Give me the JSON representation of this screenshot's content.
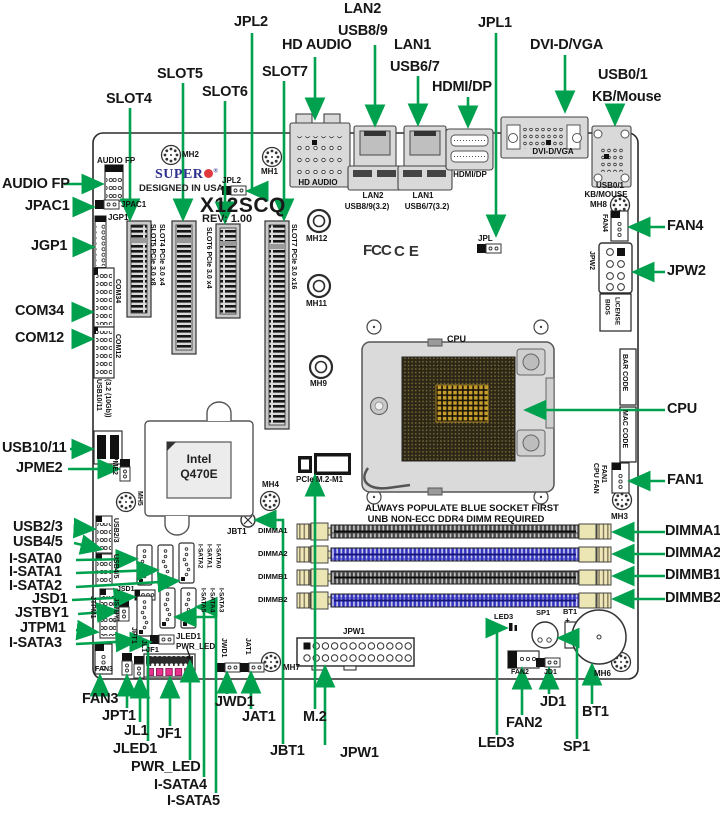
{
  "board": {
    "brand": "SUPER",
    "reg": "®",
    "designed": "DESIGNED IN USA",
    "model": "X12SCQ",
    "rev": "REV: 1.00",
    "fcc": "FCC",
    "ce": "CE",
    "cpu": "CPU",
    "chip_line1": "Intel",
    "chip_line2": "Q470E",
    "note_line1": "ALWAYS POPULATE BLUE SOCKET FIRST",
    "note_line2": "UNB NON-ECC DDR4 DIMM REQUIRED"
  },
  "colors": {
    "arrow_green": "#00A14E",
    "dimm_blue": "#3232C0",
    "logo_blue": "#2F2F8F",
    "logo_red": "#E03A3E",
    "front_panel_magenta": "#E8318A"
  },
  "callouts": {
    "top": {
      "lan2": "LAN2",
      "usb89": "USB8/9",
      "hd_audio": "HD AUDIO",
      "lan1": "LAN1",
      "usb67": "USB6/7",
      "jpl1": "JPL1",
      "dvi": "DVI-D/VGA",
      "hdmi_dp": "HDMI/DP",
      "usb01": "USB0/1",
      "kb_mouse": "KB/Mouse",
      "jpl2": "JPL2",
      "slot4": "SLOT4",
      "slot5": "SLOT5",
      "slot6": "SLOT6",
      "slot7": "SLOT7"
    },
    "left": {
      "audio_fp": "AUDIO FP",
      "jpac1": "JPAC1",
      "jgp1": "JGP1",
      "com34": "COM34",
      "com12": "COM12",
      "usb1011": "USB10/11",
      "jpme2": "JPME2",
      "usb23": "USB2/3",
      "usb45": "USB4/5",
      "isata0": "I-SATA0",
      "isata1": "I-SATA1",
      "isata2": "I-SATA2",
      "jsd1": "JSD1",
      "jstby1": "JSTBY1",
      "jtpm1": "JTPM1",
      "isata3": "I-SATA3"
    },
    "right": {
      "fan4": "FAN4",
      "jpw2": "JPW2",
      "cpu": "CPU",
      "fan1": "FAN1",
      "dimma1": "DIMMA1",
      "dimma2": "DIMMA2",
      "dimmb1": "DIMMB1",
      "dimmb2": "DIMMB2"
    },
    "bottom": {
      "fan3": "FAN3",
      "jpt1": "JPT1",
      "jl1": "JL1",
      "jf1": "JF1",
      "jled1": "JLED1",
      "pwr_led": "PWR_LED",
      "isata4": "I-SATA4",
      "isata5": "I-SATA5",
      "jwd1": "JWD1",
      "jat1": "JAT1",
      "jbt1": "JBT1",
      "m2": "M.2",
      "jpw1": "JPW1",
      "fan2": "FAN2",
      "led3": "LED3",
      "jd1": "JD1",
      "bt1": "BT1",
      "sp1": "SP1"
    }
  },
  "ports": {
    "hd_audio": "HD AUDIO",
    "lan2": "LAN2",
    "usb89": "USB8/9(3.2)",
    "lan1": "LAN1",
    "usb67": "USB6/7(3.2)",
    "hdmi_dp": "HDMI/DP",
    "dvi": "DVI-D/VGA",
    "usb01": "USB0/1",
    "kb_mouse": "KB/MOUSE"
  },
  "stickers": {
    "bios_line1": "BIOS",
    "bios_line2": "LICENSE",
    "bar_code": "BAR CODE",
    "mac_code": "MAC CODE"
  },
  "silkscreen": {
    "audio_fp": "AUDIO FP",
    "jpac1": "JPAC1",
    "jgp1": "JGP1",
    "com34": "COM34",
    "com12": "COM12",
    "usb1011_a": "USB10/11",
    "usb1011_b": "(3.2 (10Gb))",
    "jpme2": "JPME2",
    "jpl2": "JPL2",
    "jpl": "JPL",
    "mh1": "MH1",
    "mh2": "MH2",
    "mh3": "MH3",
    "mh4": "MH4",
    "mh5": "MH5",
    "mh6": "MH6",
    "mh7": "MH7",
    "mh8": "MH8",
    "mh9": "MH9",
    "mh11": "MH11",
    "mh12": "MH12",
    "fan4": "FAN4",
    "jpw2": "JPW2",
    "fan1": "FAN1",
    "cpu_fan": "CPU FAN",
    "slot4": "SLOT4 PCIe 3.0 x4",
    "slot5": "SLOT5 PCIe 3.0 x8",
    "slot6": "SLOT6 PCIe 3.0 x4",
    "slot7": "SLOT7 PCIe 3.0 x16",
    "m2": "PCIe M.2-M1",
    "jbt1": "JBT1",
    "dimma1": "DIMMA1",
    "dimma2": "DIMMA2",
    "dimmb1": "DIMMB1",
    "dimmb2": "DIMMB2",
    "usb23": "USB2/3",
    "usb45": "USB4/5",
    "sata_r1": [
      "I-SATA2",
      "I-SATA1",
      "I-SATA0"
    ],
    "sata_r2": [
      "I-SATA5",
      "I-SATA4",
      "I-SATA3"
    ],
    "jsd1": "JSD1",
    "jstby1": "JSTBY1",
    "jtpm1": "JTPM1",
    "jpt1": "JPT1",
    "jl1": "JL1",
    "jf1": "JF1",
    "jled1": "JLED1",
    "pwr_led": "PWR_LED",
    "fan3": "FAN3",
    "jwd1": "JWD1",
    "jat1": "JAT1",
    "jpw1": "JPW1",
    "fan2": "FAN2",
    "jd1": "JD1",
    "led3": "LED3",
    "sp1": "SP1",
    "bt1": "BT1",
    "plus": "+"
  }
}
